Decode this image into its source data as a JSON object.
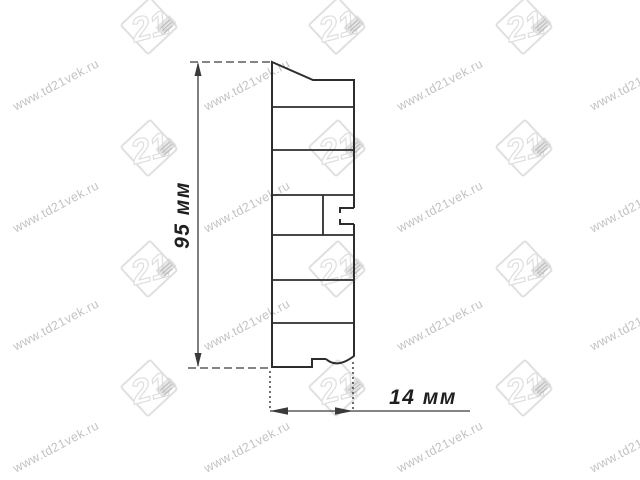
{
  "drawing": {
    "height_label": "95 мм",
    "width_label": "14 мм",
    "line_color": "#2d2d2d",
    "dim_color": "#3a3a3a",
    "label_color": "#1f1f1f"
  },
  "watermark": {
    "text": "www.td21vek.ru",
    "logo_number": "21",
    "text_color": "#c2c2c2",
    "logo_color": "#e0e0e0",
    "text_positions": [
      [
        56,
        85
      ],
      [
        247,
        85
      ],
      [
        440,
        85
      ],
      [
        633,
        85
      ],
      [
        56,
        207
      ],
      [
        247,
        207
      ],
      [
        440,
        207
      ],
      [
        633,
        207
      ],
      [
        56,
        325
      ],
      [
        247,
        325
      ],
      [
        440,
        325
      ],
      [
        633,
        325
      ],
      [
        56,
        447
      ],
      [
        247,
        447
      ],
      [
        440,
        447
      ],
      [
        633,
        447
      ]
    ],
    "logo_positions": [
      [
        152,
        28
      ],
      [
        340,
        28
      ],
      [
        527,
        28
      ],
      [
        152,
        150
      ],
      [
        340,
        150
      ],
      [
        527,
        150
      ],
      [
        152,
        271
      ],
      [
        340,
        271
      ],
      [
        527,
        271
      ],
      [
        152,
        390
      ],
      [
        340,
        390
      ],
      [
        527,
        390
      ]
    ]
  }
}
